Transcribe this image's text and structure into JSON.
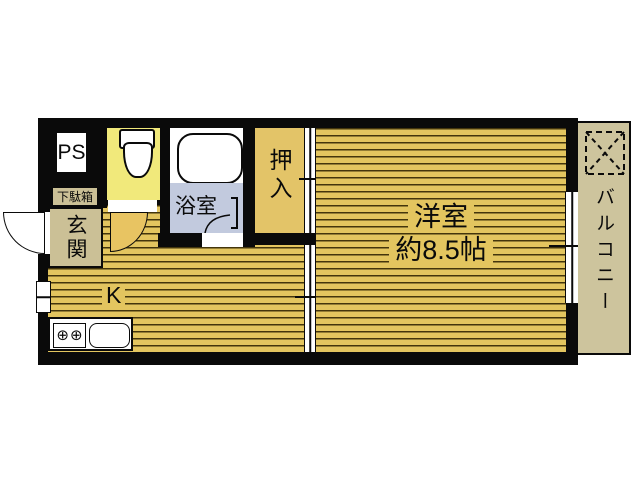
{
  "plan": {
    "labels": {
      "ps": "PS",
      "shoe_cabinet": "下駄箱",
      "entrance": "玄関",
      "bathroom": "浴室",
      "closet": "押入",
      "kitchen": "K",
      "western_room_name": "洋室",
      "western_room_size": "約8.5帖",
      "balcony": "バルコニー"
    },
    "icons": {
      "stove_burner_glyph": "⊕"
    },
    "colors": {
      "wall_black": "#0a0a0a",
      "wood_floor_gold": "#e3c55f",
      "wood_grain_line": "#43350c",
      "closet_gold": "#e3c468",
      "entrance_tan": "#cbc096",
      "balcony_tan": "#cdc49d",
      "toilet_yellow": "#f1e97b",
      "bathroom_blue": "#c2cade",
      "fixture_white": "#ffffff"
    }
  }
}
